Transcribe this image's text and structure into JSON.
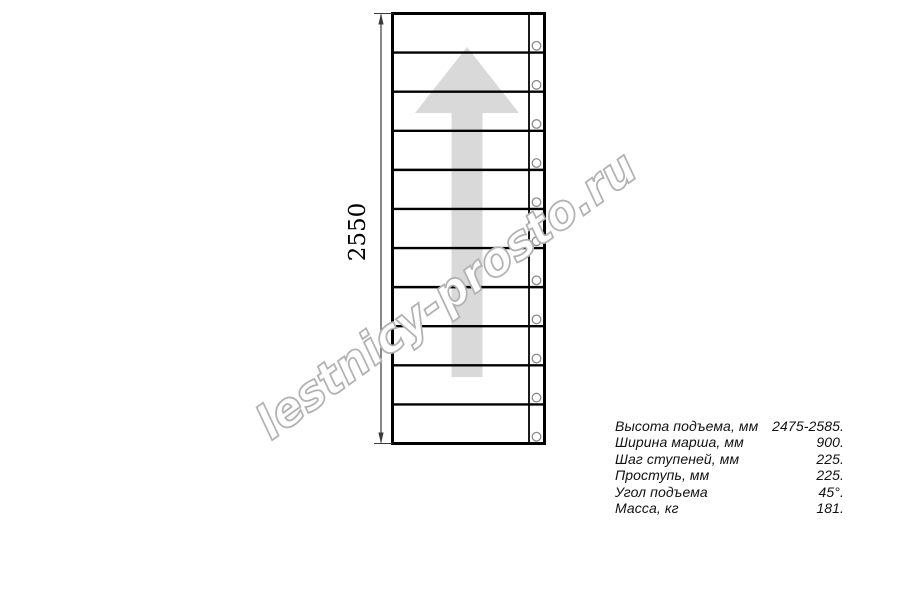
{
  "drawing": {
    "title": "stair-flight-top-view",
    "dimension_label": "2550",
    "steps_count": 11,
    "colors": {
      "line": "#000000",
      "dimension": "#3a3a3a",
      "arrow_fill": "#d9d9d9",
      "circle_stroke": "#8a8a8a"
    }
  },
  "watermark": {
    "text": "lestnicy-prosto.ru",
    "stroke_color": "#b2b2b2",
    "fill_color": "#ffffff"
  },
  "specs": {
    "rows": [
      {
        "label": "Высота подъема, мм",
        "value": "2475-2585."
      },
      {
        "label": "Ширина марша, мм",
        "value": "900."
      },
      {
        "label": "Шаг ступеней, мм",
        "value": "225."
      },
      {
        "label": "Проступь, мм",
        "value": "225."
      },
      {
        "label": "Угол подъема",
        "value": "45°."
      },
      {
        "label": "Масса, кг",
        "value": "181."
      }
    ]
  }
}
